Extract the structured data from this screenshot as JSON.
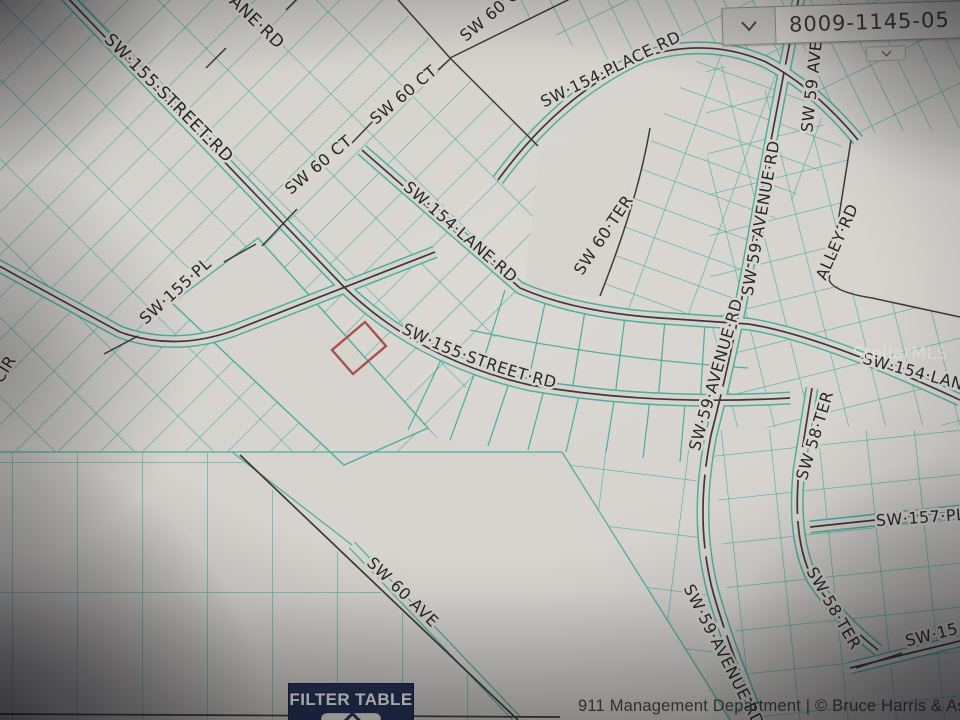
{
  "parcel_search": {
    "value": "8009-1145-05",
    "chevron_icon": "chevron-down",
    "mini_chevron_icon": "chevron-down"
  },
  "filter_table": {
    "label": "FILTER TABLE",
    "chevron_icon": "chevron-up"
  },
  "attribution": "911 Management Department | © Bruce Harris & Assoc",
  "map": {
    "watermark": "StellarMLS",
    "highlight_parcel_color": "#a85148",
    "parcel_line_color": "#4fae9d",
    "street_line_color": "#3b3a37",
    "street_labels": [
      {
        "t": "SW·155·STREET·RD",
        "x": 165,
        "y": 102,
        "r": 45,
        "size": 17
      },
      {
        "t": "ANE·RD",
        "x": 253,
        "y": 26,
        "r": 44,
        "size": 17
      },
      {
        "t": "SW 60 CT",
        "x": 497,
        "y": 16,
        "r": -40
      },
      {
        "t": "SW 60 CT",
        "x": 407,
        "y": 99,
        "r": -40
      },
      {
        "t": "SW 60 CT",
        "x": 322,
        "y": 169,
        "r": -40
      },
      {
        "t": "SW·154·PLACE RD",
        "x": 613,
        "y": 74,
        "r": -26
      },
      {
        "t": "SW·154·LANE·RD",
        "x": 457,
        "y": 236,
        "r": 41
      },
      {
        "t": "SW 60·TER",
        "x": 608,
        "y": 238,
        "r": -56
      },
      {
        "t": "SW 59 AVE",
        "x": 817,
        "y": 87,
        "r": -84
      },
      {
        "t": "SW 59·AVENUE·RD",
        "x": 766,
        "y": 219,
        "r": -80
      },
      {
        "t": "ALLEY·RD",
        "x": 842,
        "y": 244,
        "r": -66
      },
      {
        "t": "SW·155·PL",
        "x": 179,
        "y": 295,
        "r": -42
      },
      {
        "t": "CIR",
        "x": 9,
        "y": 372,
        "r": -58
      },
      {
        "t": "SW·155·STREET·RD",
        "path": "curve155",
        "offset": "10"
      },
      {
        "t": "SW·59·AVENUE·RD",
        "x": 721,
        "y": 376,
        "r": -74
      },
      {
        "t": "SW·154·LANE",
        "x": 917,
        "y": 378,
        "r": 15
      },
      {
        "t": "SW 58·TER",
        "x": 820,
        "y": 437,
        "r": -73
      },
      {
        "t": "SW·157·PL",
        "x": 921,
        "y": 523,
        "r": -4
      },
      {
        "t": "SW 58·TER",
        "x": 829,
        "y": 611,
        "r": 60
      },
      {
        "t": "SW·15",
        "x": 933,
        "y": 640,
        "r": -14
      },
      {
        "t": "SW 60 AVE",
        "x": 399,
        "y": 596,
        "r": 44
      },
      {
        "t": "SW·59·AVENUE RD",
        "x": 719,
        "y": 658,
        "r": 63
      }
    ]
  },
  "colors": {
    "filter_button_navy": "#233055",
    "map_teal": "#4fae9d",
    "highlight_red": "#a85148"
  }
}
